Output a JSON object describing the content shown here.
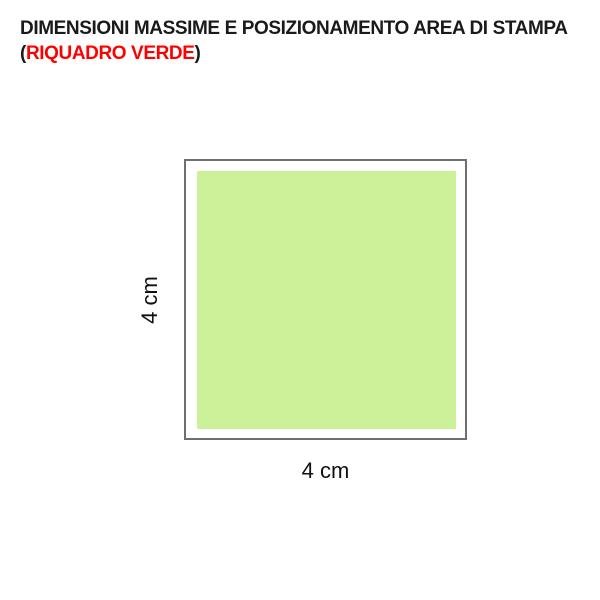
{
  "title": {
    "line1": "DIMENSIONI MASSIME E POSIZIONAMENTO AREA DI STAMPA",
    "line2_prefix": "(",
    "line2_highlight": "RIQUADRO VERDE",
    "line2_suffix": ")"
  },
  "diagram": {
    "shape": "square print area",
    "height_label": "4 cm",
    "width_label": "4 cm",
    "colors": {
      "green_fill": "#ccf199",
      "outline_gray": "#6f6f6f",
      "highlight_red": "#ff0000",
      "text_black": "#1a1a1a",
      "background": "#ffffff"
    }
  }
}
